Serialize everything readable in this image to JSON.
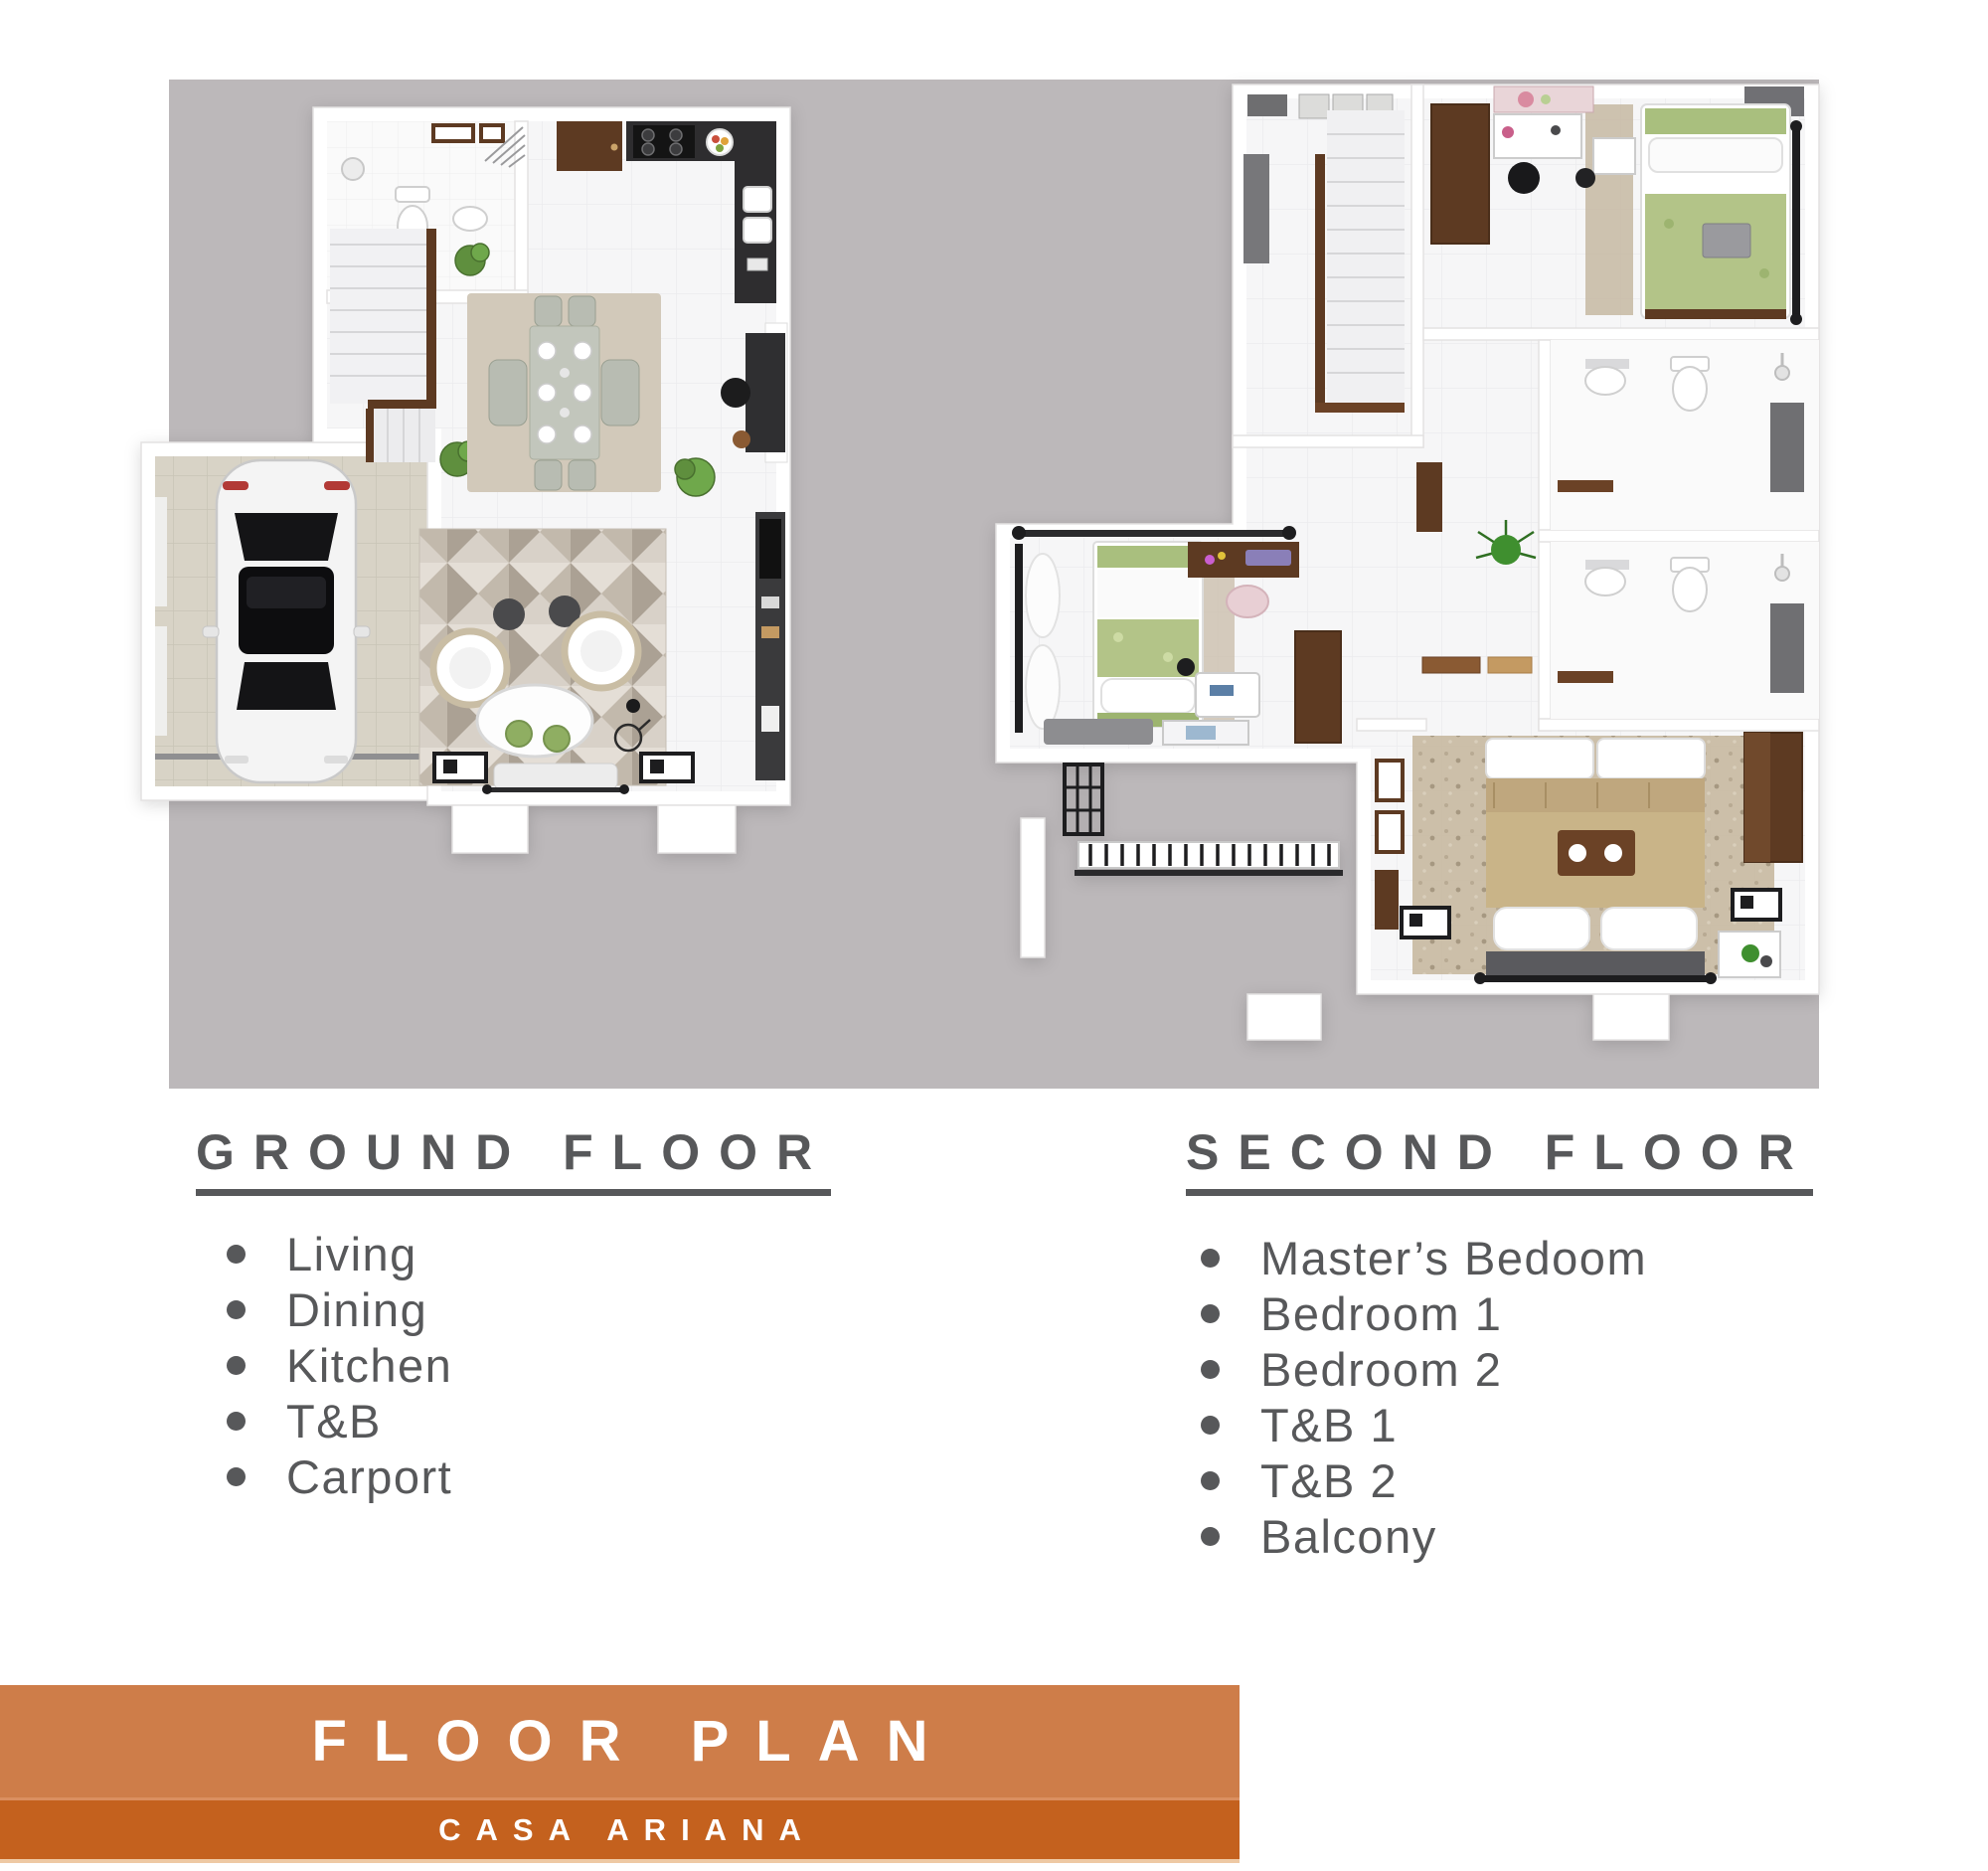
{
  "floors": {
    "ground": {
      "heading": "GROUND FLOOR",
      "items": [
        "Living",
        "Dining",
        "Kitchen",
        "T&B",
        "Carport"
      ]
    },
    "second": {
      "heading": "SECOND FLOOR",
      "items": [
        "Master’s Bedoom",
        "Bedroom 1",
        "Bedroom 2",
        "T&B 1",
        "T&B 2",
        "Balcony"
      ]
    }
  },
  "banner": {
    "title": "FLOOR PLAN",
    "subtitle": "CASA ARIANA"
  },
  "colors": {
    "panel_background": "#bcb8ba",
    "heading_text": "#57585a",
    "list_text": "#57585a",
    "banner_title_background": "#ce7d49",
    "banner_subtitle_background": "#c4611e",
    "banner_text": "#ffffff",
    "plan_floor": "#f6f6f7",
    "plan_wall": "#ffffff",
    "accent_wood": "#5d3a22",
    "accent_green": "#6fa84b"
  }
}
